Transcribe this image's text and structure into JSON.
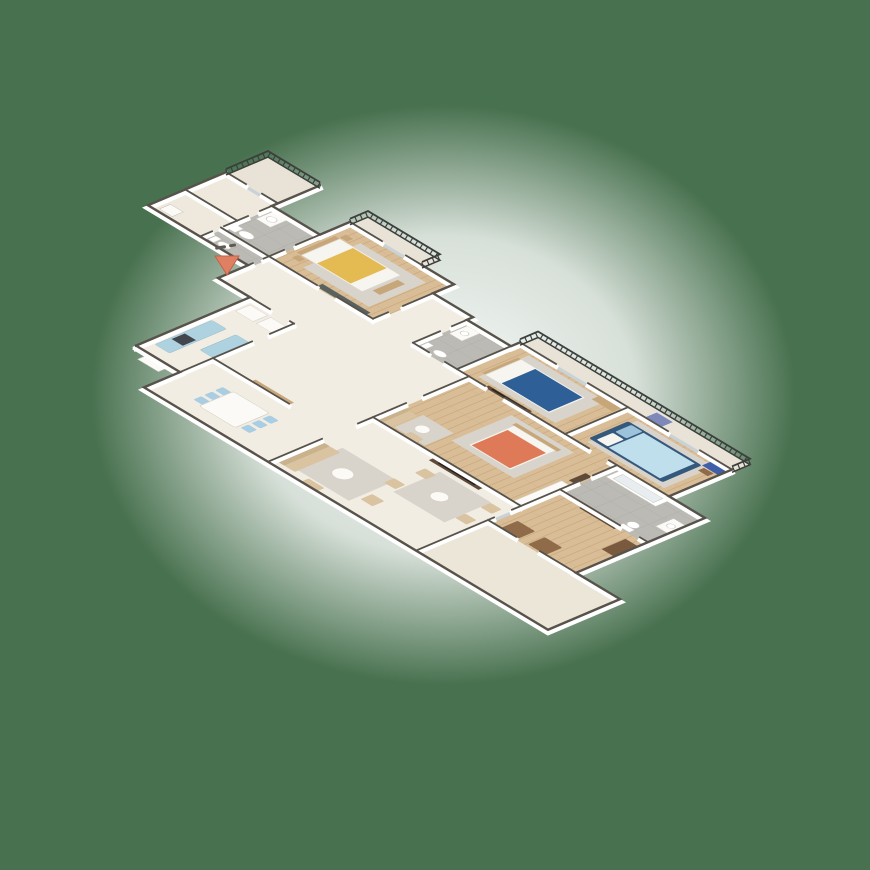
{
  "canvas": {
    "width": 870,
    "height": 870
  },
  "background": "#48714f",
  "halo_color": "#ffffff",
  "entry_marker": {
    "shape": "triangle-arrow-into-entry",
    "color": "#e08063",
    "outline": "#c26248"
  },
  "palette": {
    "wall_face": "#ffffff",
    "wall_top": "#57524a",
    "floor_cream": "#f2ede3",
    "floor_cream_alt": "#efe9dd",
    "floor_terrace": "#ece6d9",
    "floor_balcony": "#e9e3d7",
    "floor_wood": "#d9bd97",
    "floor_wood_line": "#c8a87e",
    "floor_tile": "#bbbab4",
    "floor_tile_line": "#a9a79f",
    "rug": "#d9d4cb",
    "sofa_beige": "#d9c3a0",
    "sofa_back": "#c9b28c",
    "wood_furniture": "#c7a67a",
    "dark_furniture": "#5f4a39",
    "tv_screen": "#22211f",
    "wardrobe_slate": "#59625e",
    "white_furniture": "#fbfaf7",
    "counter_blue": "#aed2e0",
    "chair_blue": "#a9cde2",
    "bed_yellow": "#e4ba52",
    "bed_coral": "#df7a58",
    "bed_navy": "#2e5f96",
    "bed_lightblue": "#bfdfec",
    "bed_frame_navy": "#35587d",
    "pillow_white": "#f7f5f0",
    "pillow_blue": "#9cc3da",
    "dresser_blue": "#3f5fa8",
    "ac_unit": "#7d88bb",
    "bench_brown": "#8f6b49",
    "armoire_brown": "#7a5a3e",
    "railing": "#3b403c",
    "glass": "#c9d2d6",
    "stove_dark": "#43474b",
    "fixture_white": "#ffffff"
  },
  "rooms": [
    {
      "id": "kitchen",
      "floor": "cream"
    },
    {
      "id": "dining-room",
      "floor": "cream"
    },
    {
      "id": "hallway",
      "floor": "cream"
    },
    {
      "id": "entry-corridor",
      "floor": "cream"
    },
    {
      "id": "living-room",
      "floor": "cream"
    },
    {
      "id": "terrace",
      "floor": "terrace"
    },
    {
      "id": "utility-room-a",
      "floor": "cream-alt"
    },
    {
      "id": "utility-room-b",
      "floor": "cream-alt"
    },
    {
      "id": "top-balcony",
      "floor": "balcony"
    },
    {
      "id": "wc",
      "floor": "tile"
    },
    {
      "id": "bathroom-1",
      "floor": "tile"
    },
    {
      "id": "bedroom-yellow",
      "floor": "wood"
    },
    {
      "id": "bedroom-balcony",
      "floor": "balcony"
    },
    {
      "id": "bathroom-2",
      "floor": "tile"
    },
    {
      "id": "bedroom-blue",
      "floor": "wood"
    },
    {
      "id": "east-balcony",
      "floor": "balcony"
    },
    {
      "id": "bedroom-lightblue",
      "floor": "wood"
    },
    {
      "id": "master-bedroom",
      "floor": "wood"
    },
    {
      "id": "big-bathroom",
      "floor": "tile"
    },
    {
      "id": "family-room",
      "floor": "wood"
    }
  ]
}
